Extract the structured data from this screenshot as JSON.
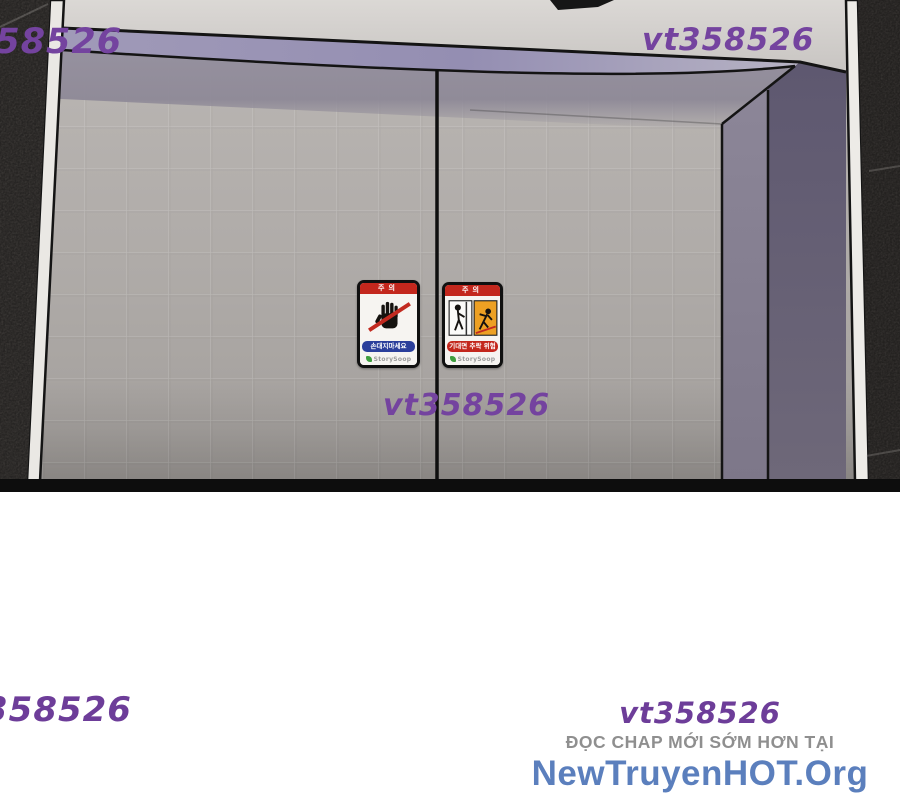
{
  "watermarks": {
    "top_left": "358526",
    "top_right": "vt358526",
    "center": "vt358526",
    "bottom_left": "358526",
    "bottom_right": "vt358526"
  },
  "promo": {
    "line1": "ĐỌC CHAP MỚI SỚM HƠN TẠI",
    "line2": "NewTruyenHOT.Org"
  },
  "stickers": {
    "left": {
      "header": "주의",
      "caption": "손대지마세요",
      "brand": "StorySoop"
    },
    "right": {
      "header": "주의",
      "caption": "기대면 추락 위험",
      "brand": "StorySoop"
    }
  },
  "colors": {
    "watermark_purple": "#74439f",
    "promo_gray": "#8f8f8f",
    "promo_blue": "#5b7fbd",
    "lintel_purple": "#9a94b4",
    "jamb_purple": "#645e72",
    "door_gray": "#b2aeab",
    "wall_dark": "#4d4945",
    "sticker_red": "#c3271d",
    "sticker_blue": "#2b3f9b"
  }
}
